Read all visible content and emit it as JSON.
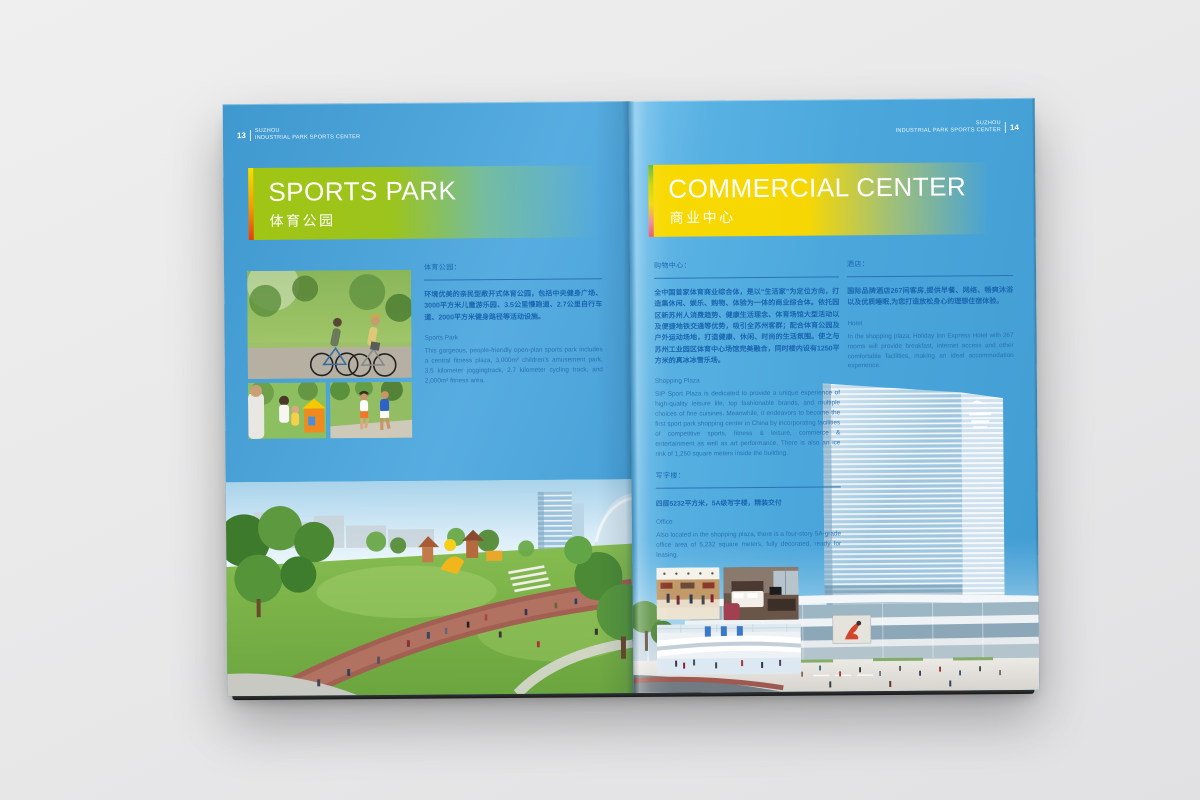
{
  "brand": {
    "line1": "SUZHOU",
    "line2": "INDUSTRIAL PARK SPORTS CENTER"
  },
  "left_page": {
    "page_number": "13",
    "banner": {
      "title": "SPORTS PARK",
      "subtitle": "体育公园"
    },
    "sports_park": {
      "label": "体育公园：",
      "cn": "环境优美的亲民型敞开式体育公园，包括中央健身广场、3000平方米儿童游乐园、3.5公里慢跑道、2.7公里自行车道、2000平方米健身路径等活动设施。",
      "en_title": "Sports Park",
      "en": "This gorgeous, people-friendly open-plan sports park includes a central fitness plaza, 3,000m² children's amusement park, 3.5 kilometer joggingtrack, 2.7 kilometer cycling track, and 2,000m² fitness area."
    },
    "photos": {
      "cycling": "couple-cycling-in-park",
      "family": "family-playing-in-park",
      "jogging": "couple-jogging",
      "main": "sports-park-rendering"
    }
  },
  "right_page": {
    "page_number": "14",
    "banner": {
      "title": "COMMERCIAL CENTER",
      "subtitle": "商业中心"
    },
    "shopping_plaza": {
      "label": "购物中心：",
      "cn": "全中国首家体育商业综合体，是以“生活家”为定位方向，打造集休闲、娱乐、购物、体验为一体的商业综合体。依托园区新苏州人消费趋势、健康生活理念、体育场馆大型活动以及便捷地铁交通等优势，吸引全苏州客群；配合体育公园及户外运动场地，打造健康、休闲、时尚的生活氛围。使之与苏州工业园区体育中心场馆完美融合，同时楼内设有1250平方米的真冰冰雪乐场。",
      "en_title": "Shopping Plaza",
      "en": "SIP Sport Plaza is dedicated to provide a unique experience of high-quality leisure life, top fashionable brands, and multiple choices of fine cuisines. Meanwhile, it endeavors to become the first sport park shopping center in China by incorporating facilities of competitive sports, fitness & leisure, commerce & entertainment as well as art performance. There is also an ice rink of 1,250 square meters inside the building."
    },
    "office": {
      "label": "写字楼：",
      "cn": "四层5232平方米，5A级写字楼，精装交付",
      "en_title": "Office",
      "en": "Also located in the shopping plaza, there is a four-story 5A-grade office area of 5,232 square meters, fully decorated, ready for leasing."
    },
    "hotel": {
      "label": "酒店：",
      "cn": "国际品牌酒店267间客房,提供早餐、网络、畅爽沐浴以及优质睡眠,为您打造放松身心的理想住宿体验。",
      "en_title": "Hotel",
      "en": "In the shopping plaza, Holiday Inn Express Hotel with 267 rooms will provide breakfast, internet access and other comfortable facilities, making an ideal accommodation experience."
    },
    "photos": {
      "mall": "shopping-mall-interior",
      "room": "hotel-guest-room",
      "atrium": "mall-atrium-ice-rink",
      "main": "commercial-center-tower-rendering"
    }
  },
  "colors": {
    "page_blue": "#4aa5db",
    "text_blue": "#1a66b0",
    "banner_green": "#a0c513",
    "banner_yellow": "#f7d705",
    "strip_warm": [
      "#f8e000",
      "#f49b00",
      "#e63a12"
    ],
    "strip_rainbow": [
      "#55b84a",
      "#c8d400",
      "#f6d400",
      "#e84f6a"
    ]
  }
}
